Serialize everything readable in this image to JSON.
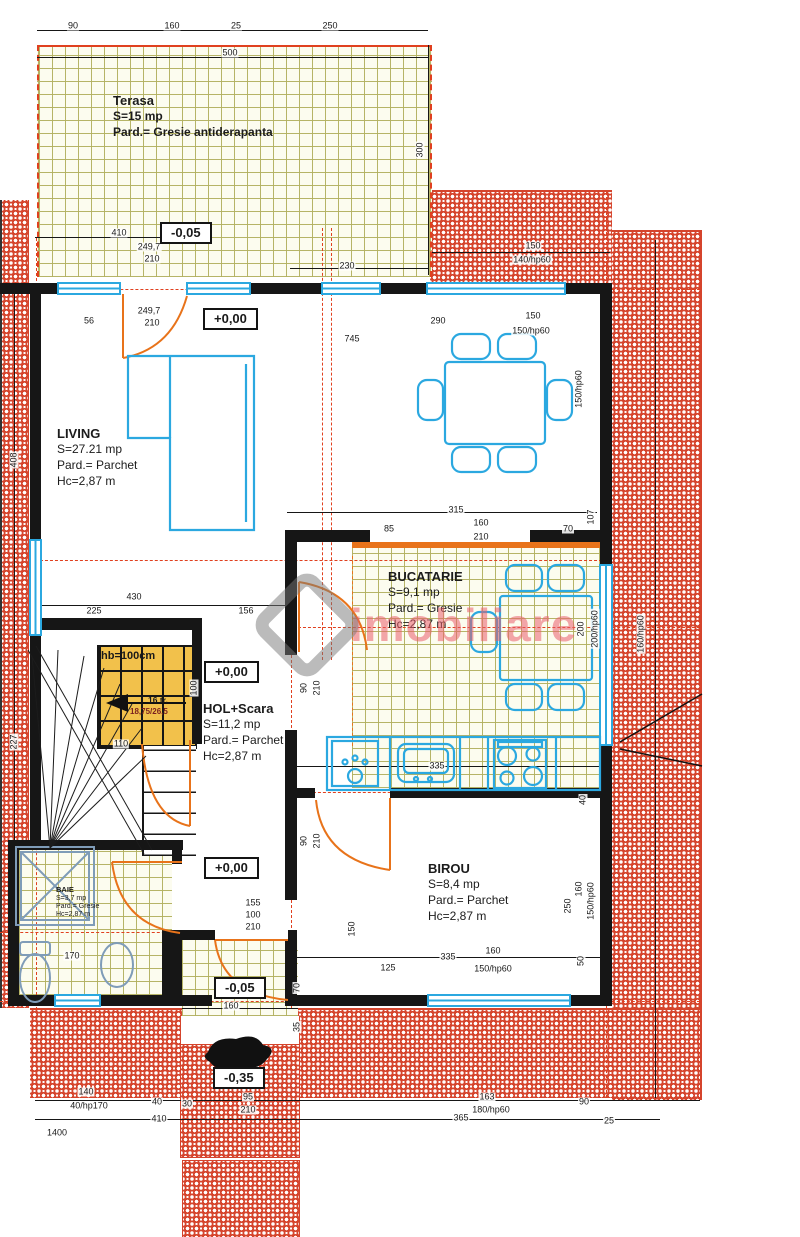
{
  "watermark": {
    "brand": "imobiliare"
  },
  "rooms": {
    "terasa": {
      "name": "Terasa",
      "area": "S=15 mp",
      "floor": "Pard.= Gresie antiderapanta"
    },
    "living": {
      "name": "LIVING",
      "area": "S=27.21 mp",
      "floor": "Pard.= Parchet",
      "height": "Hc=2,87 m"
    },
    "bucatarie": {
      "name": "BUCATARIE",
      "area": "S=9,1 mp",
      "floor": "Pard.= Gresie",
      "height": "Hc=2,87 m"
    },
    "hol": {
      "name": "HOL+Scara",
      "area": "S=11,2 mp",
      "floor": "Pard.= Parchet",
      "height": "Hc=2,87 m"
    },
    "birou": {
      "name": "BIROU",
      "area": "S=8,4 mp",
      "floor": "Pard.= Parchet",
      "height": "Hc=2,87 m"
    },
    "baie": {
      "name": "BAIE",
      "area": "S=3,7 mp",
      "floor": "Pard.= Gresie",
      "height": "Hc=2,87 m"
    }
  },
  "stairs": {
    "label": "hb=100cm",
    "steps": "16 tr.",
    "dims": "18,75/26,5"
  },
  "elevations": [
    {
      "text": "-0,05",
      "x": 160,
      "y": 222
    },
    {
      "text": "+0,00",
      "x": 203,
      "y": 308
    },
    {
      "text": "+0,00",
      "x": 204,
      "y": 661
    },
    {
      "text": "+0,00",
      "x": 204,
      "y": 857
    },
    {
      "text": "-0,05",
      "x": 214,
      "y": 977
    },
    {
      "text": "-0,35",
      "x": 213,
      "y": 1067
    }
  ],
  "dimensions": [
    {
      "t": "90",
      "x": 73,
      "y": 26
    },
    {
      "t": "160",
      "x": 172,
      "y": 26
    },
    {
      "t": "25",
      "x": 236,
      "y": 26
    },
    {
      "t": "250",
      "x": 330,
      "y": 26
    },
    {
      "t": "500",
      "x": 230,
      "y": 53
    },
    {
      "t": "300",
      "x": 420,
      "y": 150,
      "r": 1
    },
    {
      "t": "410",
      "x": 119,
      "y": 233
    },
    {
      "t": "249,7",
      "x": 149,
      "y": 247
    },
    {
      "t": "210",
      "x": 152,
      "y": 259
    },
    {
      "t": "230",
      "x": 347,
      "y": 266
    },
    {
      "t": "56",
      "x": 89,
      "y": 321
    },
    {
      "t": "249,7",
      "x": 149,
      "y": 311
    },
    {
      "t": "210",
      "x": 152,
      "y": 323
    },
    {
      "t": "290",
      "x": 438,
      "y": 321
    },
    {
      "t": "150",
      "x": 533,
      "y": 316
    },
    {
      "t": "150/hp60",
      "x": 531,
      "y": 331
    },
    {
      "t": "745",
      "x": 352,
      "y": 339
    },
    {
      "t": "150",
      "x": 533,
      "y": 246
    },
    {
      "t": "140/hp60",
      "x": 532,
      "y": 260
    },
    {
      "t": "408",
      "x": 14,
      "y": 460,
      "r": 1
    },
    {
      "t": "227",
      "x": 14,
      "y": 742,
      "r": 1
    },
    {
      "t": "430",
      "x": 134,
      "y": 597
    },
    {
      "t": "225",
      "x": 94,
      "y": 611
    },
    {
      "t": "156",
      "x": 246,
      "y": 611
    },
    {
      "t": "315",
      "x": 456,
      "y": 510
    },
    {
      "t": "85",
      "x": 389,
      "y": 529
    },
    {
      "t": "160",
      "x": 481,
      "y": 523
    },
    {
      "t": "210",
      "x": 481,
      "y": 537
    },
    {
      "t": "70",
      "x": 568,
      "y": 529
    },
    {
      "t": "107",
      "x": 591,
      "y": 517,
      "r": 1
    },
    {
      "t": "150/hp60",
      "x": 579,
      "y": 389,
      "r": 1
    },
    {
      "t": "100",
      "x": 194,
      "y": 688,
      "r": 1
    },
    {
      "t": "90",
      "x": 304,
      "y": 688,
      "r": 1
    },
    {
      "t": "210",
      "x": 317,
      "y": 688,
      "r": 1
    },
    {
      "t": "110",
      "x": 121,
      "y": 744
    },
    {
      "t": "200",
      "x": 581,
      "y": 629,
      "r": 1
    },
    {
      "t": "200/hp60",
      "x": 595,
      "y": 629,
      "r": 1
    },
    {
      "t": "160/hp60",
      "x": 641,
      "y": 634,
      "r": 1
    },
    {
      "t": "335",
      "x": 437,
      "y": 766
    },
    {
      "t": "90",
      "x": 304,
      "y": 841,
      "r": 1
    },
    {
      "t": "210",
      "x": 317,
      "y": 841,
      "r": 1
    },
    {
      "t": "155",
      "x": 253,
      "y": 903
    },
    {
      "t": "100",
      "x": 253,
      "y": 915
    },
    {
      "t": "210",
      "x": 253,
      "y": 927
    },
    {
      "t": "150",
      "x": 352,
      "y": 929,
      "r": 1
    },
    {
      "t": "250",
      "x": 568,
      "y": 906,
      "r": 1
    },
    {
      "t": "160",
      "x": 579,
      "y": 889,
      "r": 1
    },
    {
      "t": "150/hp60",
      "x": 591,
      "y": 901,
      "r": 1
    },
    {
      "t": "40",
      "x": 583,
      "y": 800,
      "r": 1
    },
    {
      "t": "50",
      "x": 581,
      "y": 961,
      "r": 1
    },
    {
      "t": "335",
      "x": 448,
      "y": 957
    },
    {
      "t": "160",
      "x": 493,
      "y": 951
    },
    {
      "t": "150/hp60",
      "x": 493,
      "y": 969
    },
    {
      "t": "125",
      "x": 388,
      "y": 968
    },
    {
      "t": "160",
      "x": 231,
      "y": 1006
    },
    {
      "t": "70",
      "x": 297,
      "y": 988,
      "r": 1
    },
    {
      "t": "35",
      "x": 297,
      "y": 1027,
      "r": 1
    },
    {
      "t": "170",
      "x": 72,
      "y": 956
    },
    {
      "t": "140",
      "x": 86,
      "y": 1092
    },
    {
      "t": "40/hp170",
      "x": 89,
      "y": 1106
    },
    {
      "t": "40",
      "x": 157,
      "y": 1102
    },
    {
      "t": "30",
      "x": 187,
      "y": 1104
    },
    {
      "t": "95",
      "x": 248,
      "y": 1097
    },
    {
      "t": "210",
      "x": 248,
      "y": 1110
    },
    {
      "t": "410",
      "x": 159,
      "y": 1119
    },
    {
      "t": "163",
      "x": 487,
      "y": 1097
    },
    {
      "t": "180/hp60",
      "x": 491,
      "y": 1110
    },
    {
      "t": "90",
      "x": 584,
      "y": 1102
    },
    {
      "t": "365",
      "x": 461,
      "y": 1118
    },
    {
      "t": "25",
      "x": 609,
      "y": 1121
    },
    {
      "t": "1400",
      "x": 57,
      "y": 1133
    }
  ],
  "colors": {
    "hatch": "#d5442c",
    "tile_line": "#b2b060",
    "window": "#2ba8e0",
    "door": "#e8731a",
    "axis": "#e0401f",
    "stair_fill": "#f2c14b",
    "watermark": "#e95c6c"
  }
}
